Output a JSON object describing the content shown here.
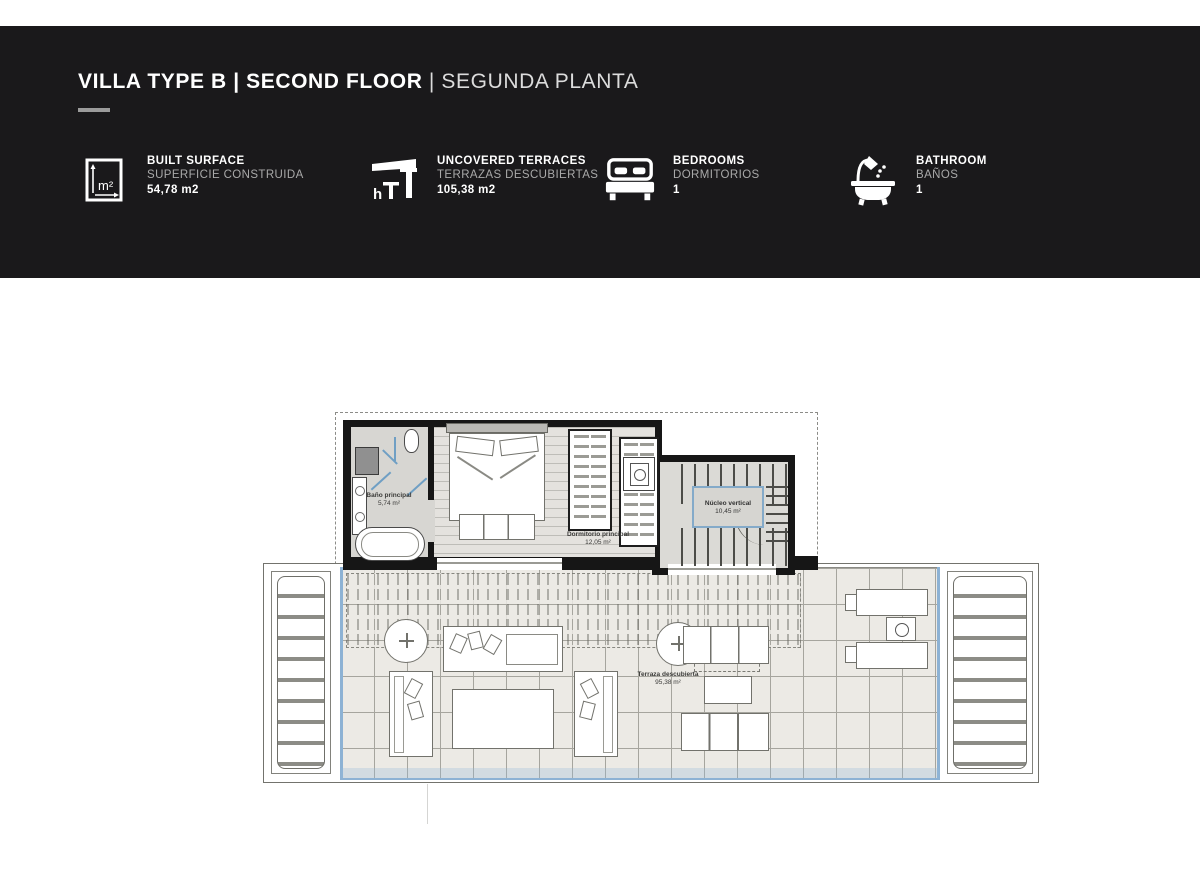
{
  "header": {
    "title": {
      "bold": "VILLA TYPE B | SECOND FLOOR",
      "separator": " | ",
      "light": "SEGUNDA PLANTA"
    },
    "stats": [
      {
        "icon": "built-surface-icon",
        "label_en": "BUILT SURFACE",
        "label_es": "SUPERFICIE CONSTRUIDA",
        "value": "54,78 m2"
      },
      {
        "icon": "uncovered-terrace-icon",
        "label_en": "UNCOVERED TERRACES",
        "label_es": "TERRAZAS DESCUBIERTAS",
        "value": "105,38 m2"
      },
      {
        "icon": "bed-icon",
        "label_en": "BEDROOMS",
        "label_es": "DORMITORIOS",
        "value": "1"
      },
      {
        "icon": "bath-icon",
        "label_en": "BATHROOM",
        "label_es": "BAÑOS",
        "value": "1"
      }
    ]
  },
  "plan": {
    "rooms": {
      "bathroom": {
        "name": "Baño principal",
        "area": "5,74 m²"
      },
      "bedroom": {
        "name": "Dormitorio principal",
        "area": "12,05 m²"
      },
      "stairs": {
        "name": "Núcleo vertical",
        "area": "10,45 m²"
      },
      "terrace": {
        "name": "Terraza descubierta",
        "area": "95,38 m²"
      }
    }
  },
  "colors": {
    "header_bg": "#1a191b",
    "accent_blue": "#84aac9",
    "rail_blue": "#8db2d4"
  }
}
